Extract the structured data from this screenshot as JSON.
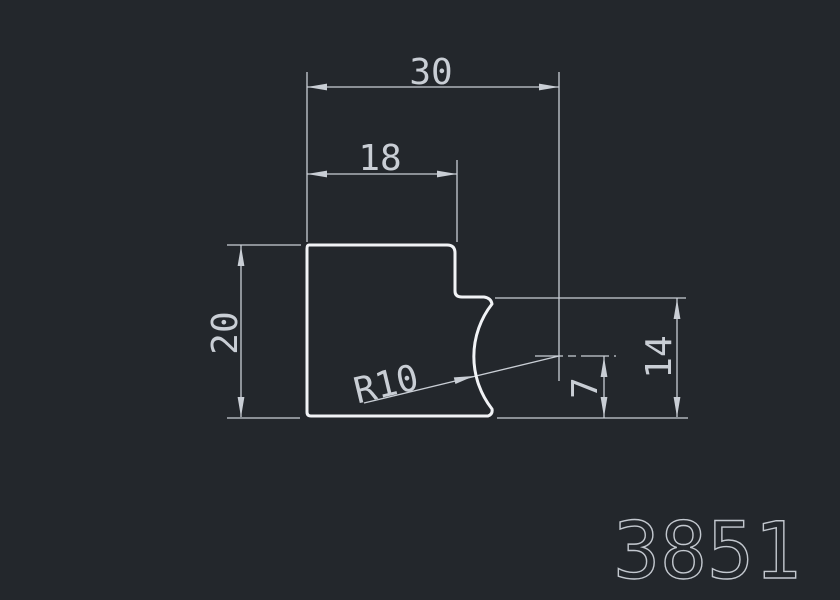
{
  "drawing": {
    "part_number": "3851",
    "dimensions": {
      "total_width": "30",
      "top_width": "18",
      "left_height": "20",
      "right_height": "14",
      "center_offset": "7",
      "radius": "R10"
    },
    "colors": {
      "background": "#23272c",
      "dimension": "#c9ced5",
      "profile": "#f1f3f6",
      "part_number": "#c3c8cf"
    }
  }
}
